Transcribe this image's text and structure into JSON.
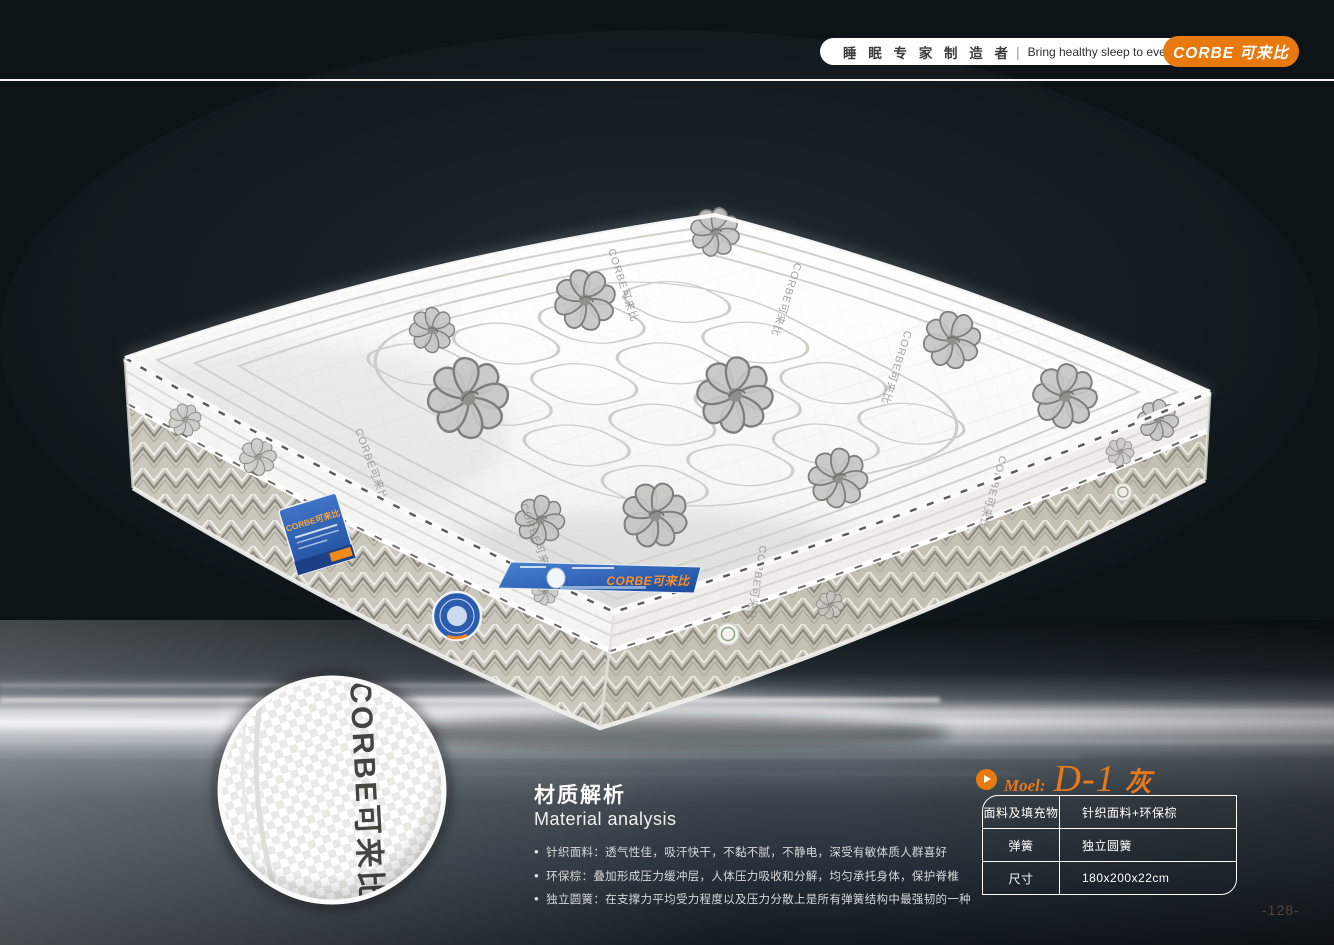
{
  "header": {
    "slogan_cn": "睡 眠 专 家 制 造 者",
    "divider": "|",
    "slogan_en": "Bring healthy sleep to everyone.",
    "brand": "CORBE 可来比",
    "brand_color": "#e8790f"
  },
  "photo": {
    "fabric_brand_mark": "CORBE可来比",
    "ribbon_text": "CORBE可来比",
    "side_label_text": "CORBE可来比",
    "inset_text": "CORBE可来比"
  },
  "material_analysis": {
    "title_cn": "材质解析",
    "title_en": "Material analysis",
    "bullets": [
      "针织面料：透气性佳，吸汗快干，不黏不腻，不静电，深受有敏体质人群喜好",
      "环保棕：叠加形成压力缓冲层，人体压力吸收和分解，均匀承托身体，保护脊椎",
      "独立圆簧：在支撑力平均受力程度以及压力分散上是所有弹簧结构中最强韧的一种"
    ]
  },
  "model_info": {
    "label": "Moel:",
    "name": "D-1",
    "variant": "灰",
    "accent_color": "#e8791b",
    "specs": [
      {
        "label": "面料及填充物",
        "value": "针织面料+环保棕"
      },
      {
        "label": "弹簧",
        "value": "独立圆簧"
      },
      {
        "label": "尺寸",
        "value": "180x200x22cm"
      }
    ]
  },
  "page": {
    "number": "-128-"
  }
}
